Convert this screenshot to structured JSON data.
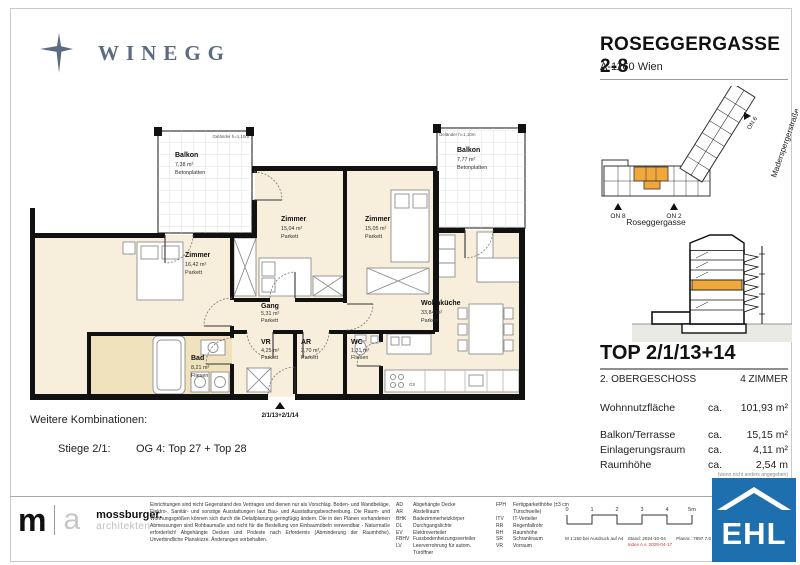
{
  "header": {
    "brand": "WINEGG",
    "title": "ROSEGGERGASSE 2-8",
    "address": "A-1160 Wien"
  },
  "site_plan": {
    "street_right": "Maderspergerstraße",
    "street_bottom": "Roseggergasse",
    "on6": "ON 6",
    "on8": "ON 8",
    "on2": "ON 2"
  },
  "unit": {
    "title": "TOP 2/1/13+14",
    "floor": "2. OBERGESCHOSS",
    "rooms": "4 ZIMMER",
    "metrics": [
      {
        "label": "Wohnnutzfläche",
        "ca": "ca.",
        "value": "101,93 m²"
      },
      {
        "label": "Balkon/Terrasse",
        "ca": "ca.",
        "value": "15,15 m²"
      },
      {
        "label": "Einlagerungsraum",
        "ca": "ca.",
        "value": "4,11 m²"
      },
      {
        "label": "Raumhöhe",
        "ca": "ca.",
        "value": "2,54 m"
      }
    ],
    "metrics_note": "(wenn nicht anders angegeben)"
  },
  "plan": {
    "rooms": [
      {
        "name": "Balkon",
        "area": "7,38 m²",
        "floor": "Betonplatten"
      },
      {
        "name": "Balkon",
        "area": "7,77 m²",
        "floor": "Betonplatten"
      },
      {
        "name": "Zimmer",
        "area": "16,42 m²",
        "floor": "Parkett"
      },
      {
        "name": "Zimmer",
        "area": "15,04 m²",
        "floor": "Parkett"
      },
      {
        "name": "Zimmer",
        "area": "15,05 m²",
        "floor": "Parkett"
      },
      {
        "name": "Wohnküche",
        "area": "33,84 m²",
        "floor": "Parkett"
      },
      {
        "name": "Gang",
        "area": "5,31 m²",
        "floor": "Parkett"
      },
      {
        "name": "VR",
        "area": "4,25 m²",
        "floor": "Parkett"
      },
      {
        "name": "AR",
        "area": "2,70 m²",
        "floor": "Parkett"
      },
      {
        "name": "WC",
        "area": "1,31 m²",
        "floor": "Fliesen"
      },
      {
        "name": "Bad",
        "area": "8,21 m²",
        "floor": "Fliesen"
      }
    ],
    "entry_label": "2/1/13+2/1/14",
    "railing_note_left": "Geländer h=1,10m",
    "railing_note_right": "Geländer h=1,10m",
    "kitchen_gs": "GS"
  },
  "combinations": {
    "heading": "Weitere Kombinationen:",
    "stiege": "Stiege 2/1:",
    "tops": "OG 4: Top 27 + Top 28"
  },
  "footer": {
    "architect": {
      "m": "m",
      "a": "a",
      "name": "mossburger.",
      "sub": "architekten"
    },
    "disclaimer": "Einrichtungen sind nicht Gegenstand des Vertrages und dienen nur als Vorschlag. Boden- und Wandbeläge, Elektro-, Sanitär- und sonstige Ausstattungen laut Bau- und Ausstattungsbeschreibung. Die Raum- und Wohnungsgrößen können sich durch die Detailplanung geringfügig ändern. Die in den Plänen vorhandenen Abmessungen sind Rohbaumaße und nicht für die Bestellung von Einbaumöbeln verwendbar - Naturmaße erforderlich! Abgehängte Decken und Podeste nach Erfordernis (Abminderung der Raumhöhe). Unverbindliche Planskizze. Änderungen vorbehalten.",
    "abbr_col1": [
      {
        "abbr": "AD",
        "label": "Abgehängte Decke"
      },
      {
        "abbr": "AR",
        "label": "Abstellraum"
      },
      {
        "abbr": "BHK",
        "label": "Badezimmerheizkörper"
      },
      {
        "abbr": "DL",
        "label": "Durchgangslichte"
      },
      {
        "abbr": "EV",
        "label": "Elektroverteiler"
      },
      {
        "abbr": "FBHV",
        "label": "Fussbodenheizungsverteiler"
      },
      {
        "abbr": "LV",
        "label": "Leerverrohrung für autom. Türöffner"
      }
    ],
    "abbr_col2": [
      {
        "abbr": "FPH",
        "label": "Fertigparketthöhe (±3 cm Türschwelle)"
      },
      {
        "abbr": "ITV",
        "label": "IT-Verteiler"
      },
      {
        "abbr": "RR",
        "label": "Regenfallrohr"
      },
      {
        "abbr": "RH",
        "label": "Raumhöhe"
      },
      {
        "abbr": "SR",
        "label": "Schrankraum"
      },
      {
        "abbr": "VR",
        "label": "Vorraum"
      }
    ],
    "scale_ticks": [
      "0",
      "1",
      "2",
      "3",
      "4",
      "5m"
    ],
    "scale_note": "M 1:150 bei Ausdruck auf A4",
    "stand": "Stand: 2024-10-04",
    "index": "Index A v. 2025-04-17",
    "plan_no": "Plannr.: 7897.7.6",
    "ehl": "EHL"
  },
  "colors": {
    "accent_orange": "#F0A83C",
    "floor_cream": "#F7EEDC",
    "bad_tan": "#F0E2BD",
    "wall_black": "#111111",
    "winegg_blue": "#5D6B80",
    "ehl_blue": "#1E6FAE",
    "index_red": "#C23A2F"
  }
}
